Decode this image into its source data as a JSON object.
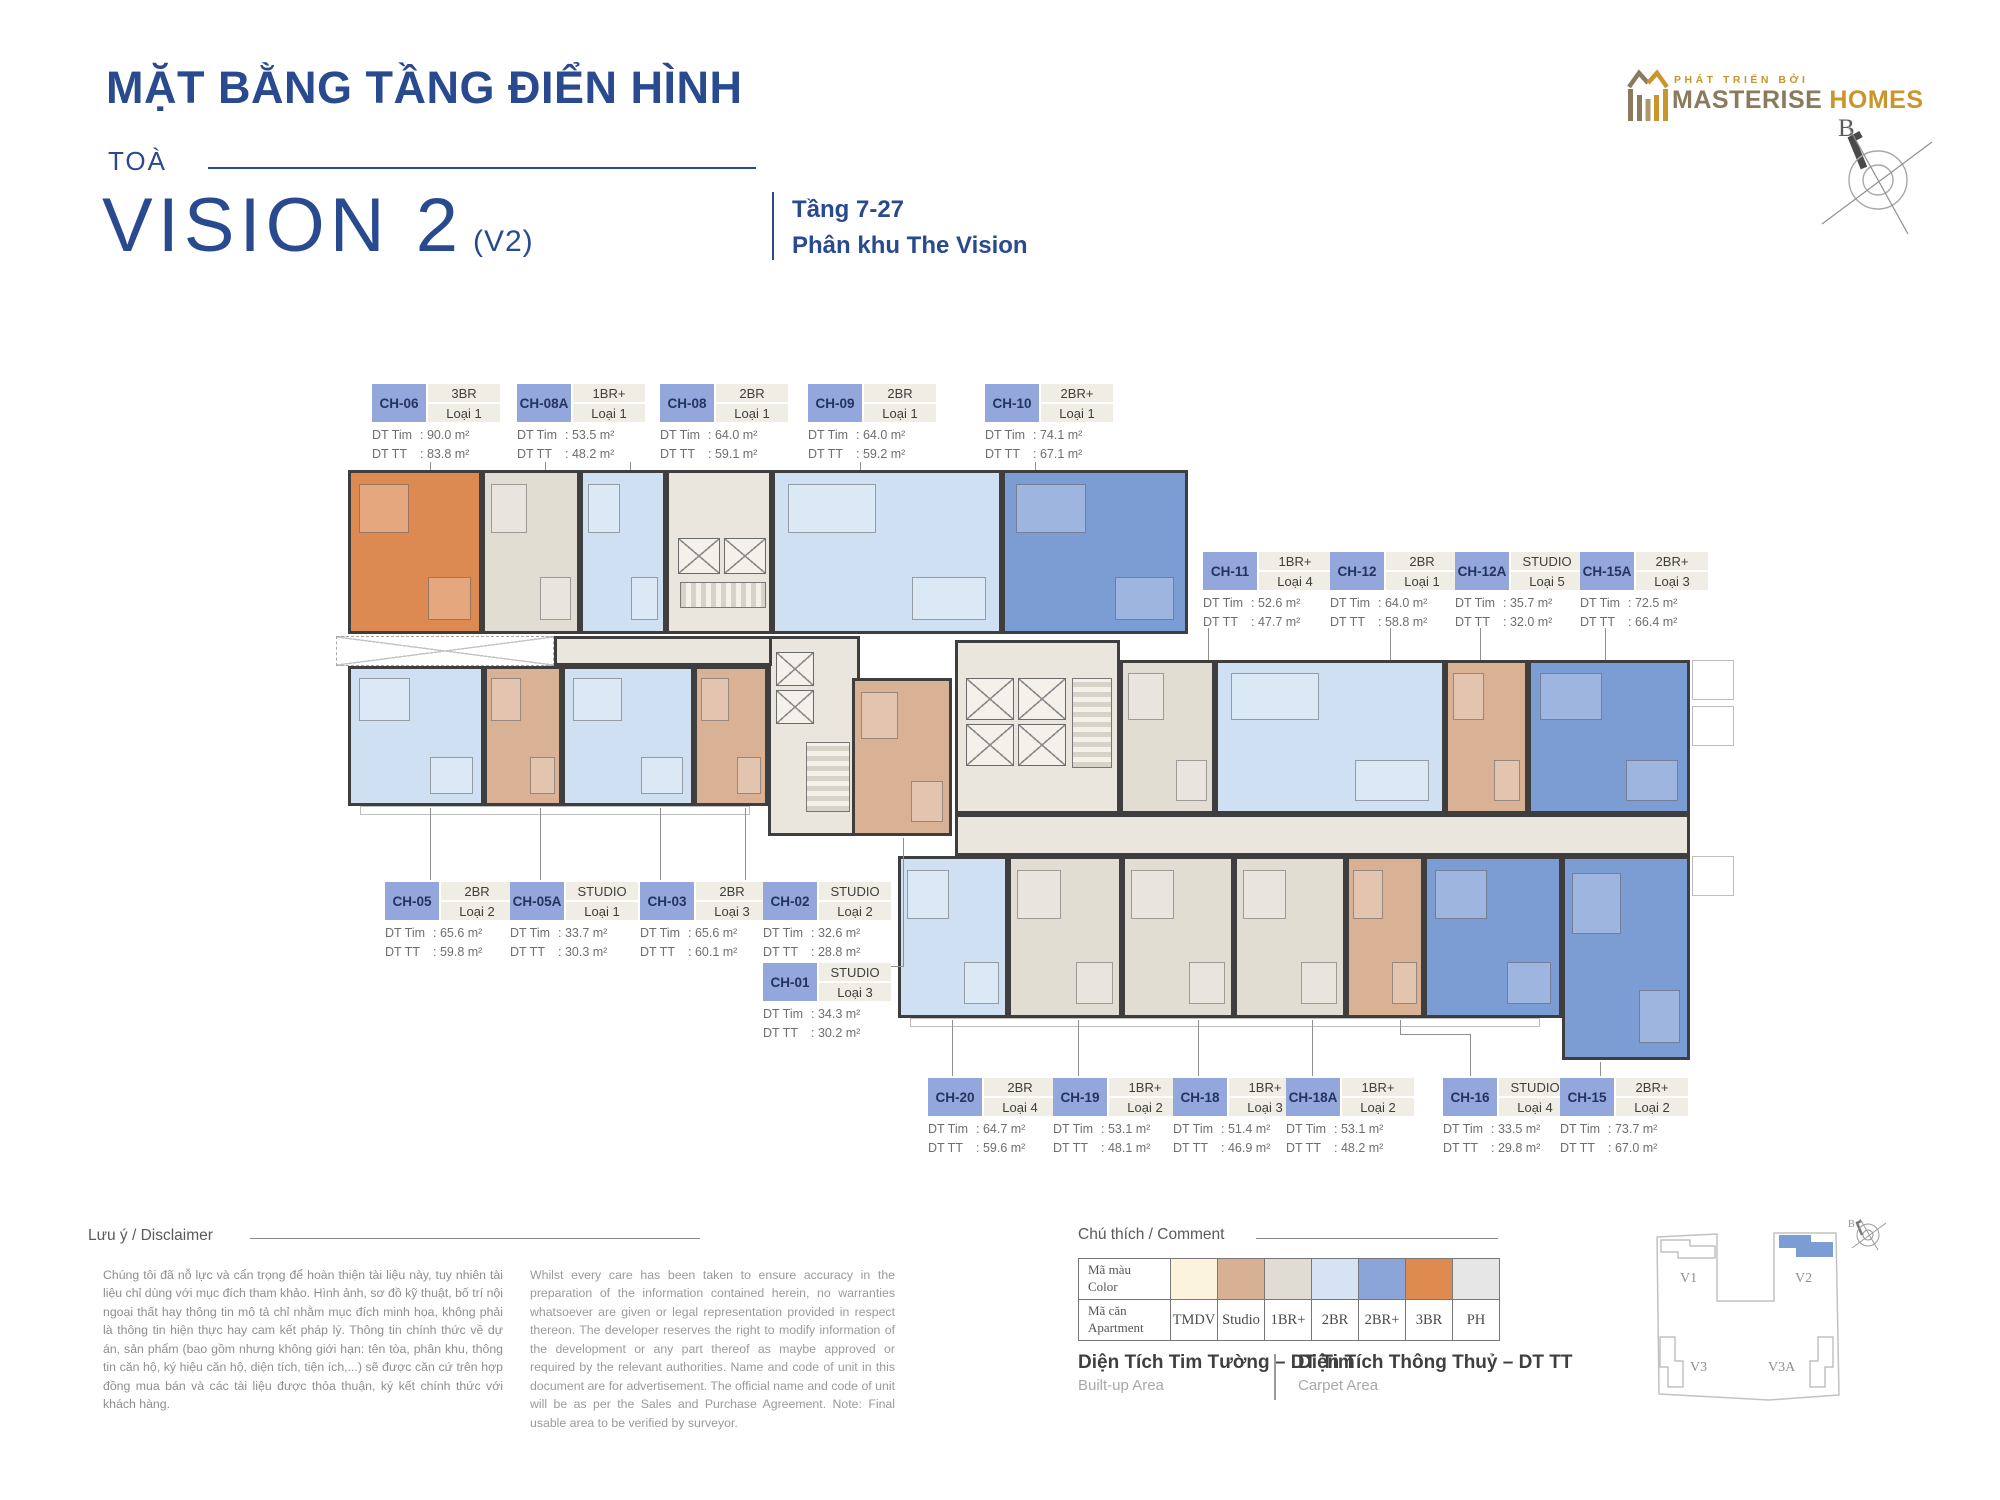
{
  "header": {
    "title": "MẶT BẰNG TẦNG ĐIỂN HÌNH",
    "tower_prefix": "TOÀ",
    "tower_name": "VISION 2",
    "tower_code": "(V2)",
    "floors": "Tầng 7-27",
    "subdivision": "Phân khu The Vision",
    "compass_label": "B"
  },
  "developer": {
    "tagline": "PHÁT TRIỂN BỞI",
    "brand_primary": "MASTERISE",
    "brand_secondary": "HOMES"
  },
  "area_labels": {
    "built": "DT Tim",
    "carpet": "DT TT"
  },
  "units": [
    {
      "code": "CH-06",
      "type": "3BR",
      "variant": "Loại 1",
      "dt_tim": "90.0 m²",
      "dt_tt": "83.8 m²",
      "color_key": "3BR"
    },
    {
      "code": "CH-08A",
      "type": "1BR+",
      "variant": "Loại 1",
      "dt_tim": "53.5 m²",
      "dt_tt": "48.2 m²",
      "color_key": "1BR+"
    },
    {
      "code": "CH-08",
      "type": "2BR",
      "variant": "Loại 1",
      "dt_tim": "64.0 m²",
      "dt_tt": "59.1 m²",
      "color_key": "2BR"
    },
    {
      "code": "CH-09",
      "type": "2BR",
      "variant": "Loại 1",
      "dt_tim": "64.0 m²",
      "dt_tt": "59.2 m²",
      "color_key": "2BR"
    },
    {
      "code": "CH-10",
      "type": "2BR+",
      "variant": "Loại 1",
      "dt_tim": "74.1 m²",
      "dt_tt": "67.1 m²",
      "color_key": "2BR+"
    },
    {
      "code": "CH-11",
      "type": "1BR+",
      "variant": "Loại 4",
      "dt_tim": "52.6 m²",
      "dt_tt": "47.7 m²",
      "color_key": "1BR+"
    },
    {
      "code": "CH-12",
      "type": "2BR",
      "variant": "Loại 1",
      "dt_tim": "64.0 m²",
      "dt_tt": "58.8 m²",
      "color_key": "2BR"
    },
    {
      "code": "CH-12A",
      "type": "STUDIO",
      "variant": "Loại 5",
      "dt_tim": "35.7 m²",
      "dt_tt": "32.0 m²",
      "color_key": "Studio"
    },
    {
      "code": "CH-15A",
      "type": "2BR+",
      "variant": "Loại 3",
      "dt_tim": "72.5 m²",
      "dt_tt": "66.4 m²",
      "color_key": "2BR+"
    },
    {
      "code": "CH-05",
      "type": "2BR",
      "variant": "Loại 2",
      "dt_tim": "65.6 m²",
      "dt_tt": "59.8 m²",
      "color_key": "2BR"
    },
    {
      "code": "CH-05A",
      "type": "STUDIO",
      "variant": "Loại 1",
      "dt_tim": "33.7 m²",
      "dt_tt": "30.3 m²",
      "color_key": "Studio"
    },
    {
      "code": "CH-03",
      "type": "2BR",
      "variant": "Loại 3",
      "dt_tim": "65.6 m²",
      "dt_tt": "60.1 m²",
      "color_key": "2BR"
    },
    {
      "code": "CH-02",
      "type": "STUDIO",
      "variant": "Loại 2",
      "dt_tim": "32.6 m²",
      "dt_tt": "28.8 m²",
      "color_key": "Studio"
    },
    {
      "code": "CH-01",
      "type": "STUDIO",
      "variant": "Loại 3",
      "dt_tim": "34.3 m²",
      "dt_tt": "30.2 m²",
      "color_key": "Studio"
    },
    {
      "code": "CH-20",
      "type": "2BR",
      "variant": "Loại 4",
      "dt_tim": "64.7 m²",
      "dt_tt": "59.6 m²",
      "color_key": "2BR"
    },
    {
      "code": "CH-19",
      "type": "1BR+",
      "variant": "Loại 2",
      "dt_tim": "53.1 m²",
      "dt_tt": "48.1 m²",
      "color_key": "1BR+"
    },
    {
      "code": "CH-18",
      "type": "1BR+",
      "variant": "Loại 3",
      "dt_tim": "51.4 m²",
      "dt_tt": "46.9 m²",
      "color_key": "1BR+"
    },
    {
      "code": "CH-18A",
      "type": "1BR+",
      "variant": "Loại 2",
      "dt_tim": "53.1 m²",
      "dt_tt": "48.2 m²",
      "color_key": "1BR+"
    },
    {
      "code": "CH-16",
      "type": "STUDIO",
      "variant": "Loại 4",
      "dt_tim": "33.5 m²",
      "dt_tt": "29.8 m²",
      "color_key": "Studio"
    },
    {
      "code": "CH-15",
      "type": "2BR+",
      "variant": "Loại 2",
      "dt_tim": "73.7 m²",
      "dt_tt": "67.0 m²",
      "color_key": "2BR+"
    }
  ],
  "disclaimer": {
    "heading": "Lưu ý / Disclaimer",
    "vietnamese": "Chúng tôi đã nỗ lực và cẩn trọng để hoàn thiện tài liệu này, tuy nhiên tài liệu chỉ dùng với mục đích tham khảo. Hình ảnh, sơ đồ kỹ thuật, bố trí nội ngoại thất hay thông tin mô tả chỉ nhằm mục đích minh họa, không phải là thông tin hiện thực hay cam kết pháp lý. Thông tin chính thức về dự án, sản phẩm (bao gồm nhưng không giới hạn: tên tòa, phân khu, thông tin căn hộ, ký hiệu căn hộ, diện tích, tiện ích,...) sẽ được căn cứ trên hợp đồng mua bán và các tài liệu được thỏa thuận, ký kết chính thức với khách hàng.",
    "english": "Whilst every care has been taken to ensure accuracy in the preparation of the information contained herein, no warranties whatsoever are given or legal representation provided in respect thereon. The developer reserves the right to modify information of the development or any part thereof as maybe approved or required by the relevant authorities. Name and code of unit in this document are for advertisement. The official name and code of unit will be as per the Sales and Purchase Agreement. Note: Final usable area to be verified by surveyor."
  },
  "legend": {
    "heading": "Chú thích / Comment",
    "row_headers": [
      {
        "vn": "Mã màu",
        "en": "Color"
      },
      {
        "vn": "Mã căn",
        "en": "Apartment"
      }
    ],
    "items": [
      {
        "label": "TMDV",
        "color": "#FCF3DC"
      },
      {
        "label": "Studio",
        "color": "#D8B094"
      },
      {
        "label": "1BR+",
        "color": "#E0DCD3"
      },
      {
        "label": "2BR",
        "color": "#D5E3F5"
      },
      {
        "label": "2BR+",
        "color": "#8CA5D8"
      },
      {
        "label": "3BR",
        "color": "#DF8A4F"
      },
      {
        "label": "PH",
        "color": "#E6E6E6"
      }
    ],
    "built_term": {
      "vn": "Diện Tích Tim Tường – DT Tim",
      "en": "Built-up Area"
    },
    "carpet_term": {
      "vn": "Diện Tích Thông Thuỷ – DT TT",
      "en": "Carpet Area"
    }
  },
  "sitemap": {
    "buildings": [
      "V1",
      "V2",
      "V3",
      "V3A"
    ],
    "highlighted": "V2"
  },
  "colors": {
    "accent_blue": "#2A4A8F",
    "chip_bg": "#93A7DC",
    "chip_text": "#24335F",
    "wall": "#3E3E3E",
    "core_fill": "#EAE6DD",
    "brand_taupe": "#8A7A5E",
    "brand_gold": "#C9952C",
    "sitemap_highlight": "#7C9CD4",
    "plan": {
      "3BR": "#DC8A52",
      "2BR": "#CFE0F3",
      "2BR+": "#7C9CD4",
      "1BR+": "#E2DDD3",
      "Studio": "#D9B195",
      "TMDV": "#FCF3DC",
      "PH": "#E6E6E6"
    }
  }
}
